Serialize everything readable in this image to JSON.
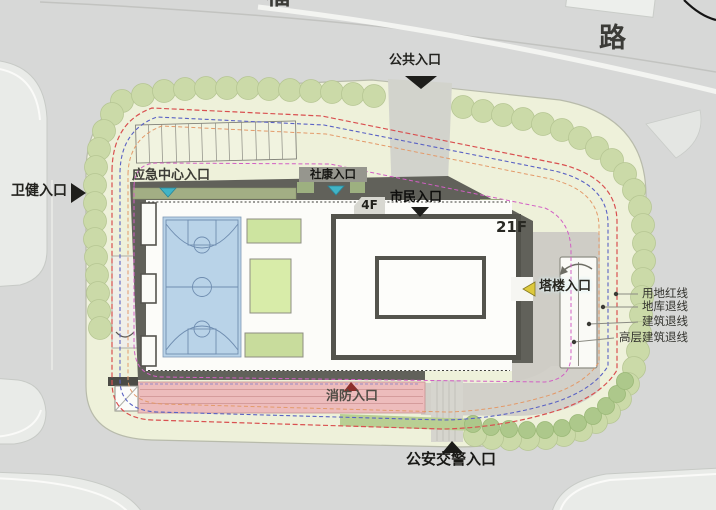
{
  "road": {
    "partial_top": "福",
    "right_label": "路"
  },
  "entrances": {
    "public": {
      "label": "公共入口"
    },
    "health": {
      "label": "卫健入口"
    },
    "emergency_center": {
      "label": "应急中心入口"
    },
    "community_health": {
      "label": "社康入口"
    },
    "citizen": {
      "label": "市民入口"
    },
    "tower": {
      "label": "塔楼入口"
    },
    "fire": {
      "label": "消防入口"
    },
    "traffic_police": {
      "label": "公安交警入口"
    }
  },
  "buildings": {
    "podium_floor_label": "4F",
    "tower_floor_label": "21F"
  },
  "legend": {
    "items": [
      {
        "label": "用地红线",
        "color": "#d95050"
      },
      {
        "label": "地库退线",
        "color": "#5a62c4"
      },
      {
        "label": "建筑退线",
        "color": "#e39a6a"
      },
      {
        "label": "高层建筑退线",
        "color": "#d25fc4"
      }
    ]
  },
  "colors": {
    "site_green": "#eef1da",
    "court_blue": "#b9d3e8",
    "fire_lane_pink": "#edbcbc",
    "tree_green": "#cbdaa8",
    "podium_gray": "#61615a"
  }
}
